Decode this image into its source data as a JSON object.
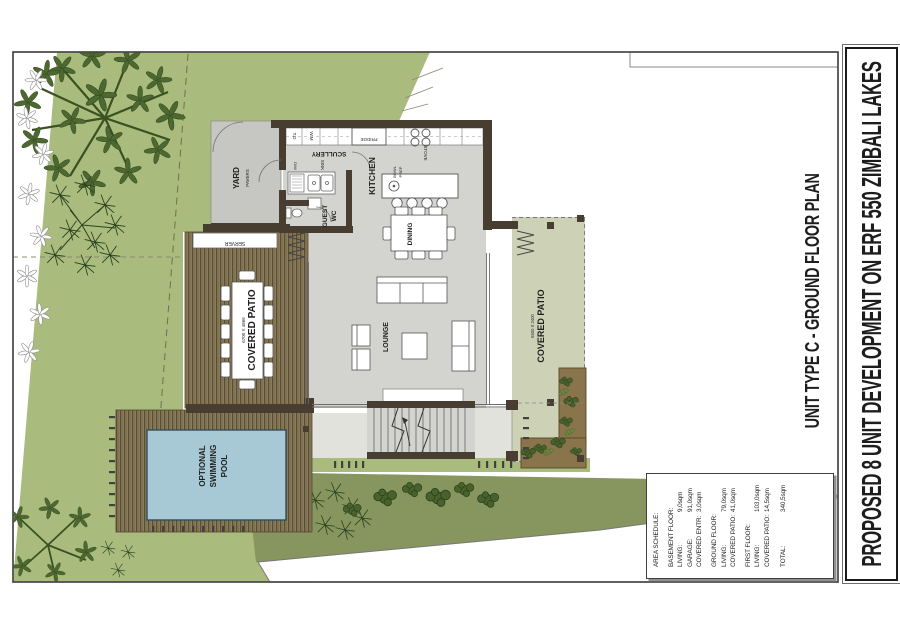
{
  "titles": {
    "project": "PROPOSED 8 UNIT DEVELOPMENT ON ERF 550 ZIMBALI LAKES",
    "drawing": "UNIT TYPE C  -  GROUND FLOOR PLAN"
  },
  "area_schedule": {
    "rows": [
      {
        "label": "AREA SCHEDULE:",
        "value": ""
      },
      {
        "label": "BASEMENT FLOOR:",
        "value": ""
      },
      {
        "label": "LIVING:",
        "value": "9,0sqm"
      },
      {
        "label": "GARAGE:",
        "value": "91,0sqm"
      },
      {
        "label": "COVERED ENTR:",
        "value": "3,0sqm"
      },
      {
        "label": "GROUND FLOOR:",
        "value": ""
      },
      {
        "label": "LIVING:",
        "value": "79,0sqm"
      },
      {
        "label": "COVERED PATIO:",
        "value": "41,0sqm"
      },
      {
        "label": "FIRST  FLOOR:",
        "value": ""
      },
      {
        "label": "LIVING:",
        "value": "103,0sqm"
      },
      {
        "label": "COVERED PATIO:",
        "value": "14,5sqm"
      },
      {
        "label": "TOTAL:",
        "value": "340,5sqm"
      }
    ]
  },
  "plan": {
    "labels": {
      "yard": "YARD",
      "yard_sub": "PAVERS",
      "scullery": "SCULLERY",
      "kitchen": "KITCHEN",
      "bowl_1": "BOWL",
      "bowl_2": "PREP",
      "guest_1": "GUEST",
      "guest_2": "WC",
      "dining": "DINING",
      "lounge": "LOUNGE",
      "server": "SERVER",
      "patio_left_dim": "6700 X 4866",
      "patio_left": "COVERED PATIO",
      "patio_right_dim": "6500 X 2400",
      "patio_right": "COVERED PATIO",
      "pool_1": "OPTIONAL",
      "pool_2": "SWIMMING",
      "pool_3": "POOL",
      "fridge": "FRIDGE",
      "stove": "STOVE",
      "sink": "SINK",
      "dw": "D/W",
      "td": "T.D",
      "wm": "W.M"
    },
    "colors": {
      "lawn": "#a9bb7d",
      "slope_bank": "#87965f",
      "deck_wood": "#8f815f",
      "deck_stripe": "#5a4d35",
      "floor": "#d3d3d0",
      "yard_pavers": "#c6c6c3",
      "patio_screed": "#cdd2b6",
      "pool_water": "#a7c9d6",
      "wall": "#473d31",
      "planter_soil": "#8a744b",
      "foliage": "#4d6831"
    }
  }
}
